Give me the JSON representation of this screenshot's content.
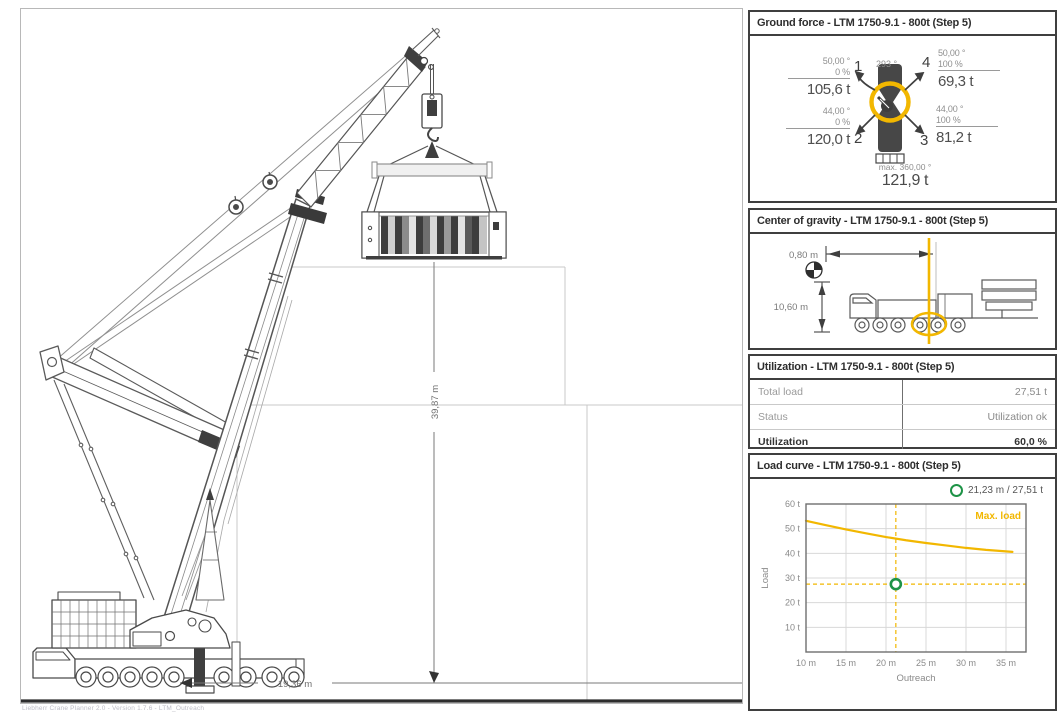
{
  "footer": {
    "text": "Liebherr Crane Planner 2.0 - Version 1.7.6 - LTM_Outreach"
  },
  "drawing": {
    "dim_height": "39,87 m",
    "dim_outreach": "19,36 m"
  },
  "colors": {
    "accent_yellow": "#F2B700",
    "marker_green": "#1E9347",
    "line_dark": "#4a4a4a"
  },
  "panels": {
    "ground_force": {
      "title": "Ground force - LTM 1750-9.1 - 800t (Step 5)",
      "slew_angle": "293 °",
      "outriggers": [
        {
          "num": "1",
          "angle": "50,00 °",
          "percent": "0 %",
          "force": "105,6 t"
        },
        {
          "num": "2",
          "angle": "44,00 °",
          "percent": "0 %",
          "force": "120,0 t"
        },
        {
          "num": "3",
          "angle": "44,00 °",
          "percent": "100 %",
          "force": "81,2 t"
        },
        {
          "num": "4",
          "angle": "50,00 °",
          "percent": "100 %",
          "force": "69,3 t"
        }
      ],
      "max_label": "max. 360,00 °",
      "max_force": "121,9 t"
    },
    "center_of_gravity": {
      "title": "Center of gravity - LTM 1750-9.1 - 800t (Step 5)",
      "horizontal_offset": "0,80 m",
      "vertical_offset": "10,60 m"
    },
    "utilization": {
      "title": "Utilization - LTM 1750-9.1 - 800t (Step 5)",
      "rows": [
        {
          "label": "Total load",
          "value": "27,51 t"
        },
        {
          "label": "Status",
          "value": "Utilization ok"
        },
        {
          "label": "Utilization",
          "value": "60,0 %"
        }
      ]
    },
    "load_curve": {
      "title": "Load curve - LTM 1750-9.1 - 800t (Step 5)",
      "chart_data": {
        "type": "line",
        "xlabel": "Outreach",
        "ylabel": "Load",
        "x_unit": "m",
        "y_unit": "t",
        "xlim": [
          10,
          37.5
        ],
        "ylim": [
          0,
          60
        ],
        "x_ticks": [
          10,
          15,
          20,
          25,
          30,
          35
        ],
        "y_ticks": [
          10,
          20,
          30,
          40,
          50,
          60
        ],
        "grid": true,
        "legend_position": "top-right",
        "series": [
          {
            "name": "Max. load",
            "color": "#F2B700",
            "x": [
              10,
              12.5,
              15,
              17.5,
              20,
              22.5,
              25,
              27.5,
              30,
              32.5,
              35,
              35.8
            ],
            "y": [
              53.2,
              51.4,
              49.7,
              48.1,
              46.6,
              45.3,
              44.2,
              43.2,
              42.2,
              41.4,
              40.8,
              40.6
            ]
          }
        ],
        "marker": {
          "x": 21.23,
          "y": 27.51,
          "label": "21,23 m / 27,51 t"
        }
      }
    }
  }
}
